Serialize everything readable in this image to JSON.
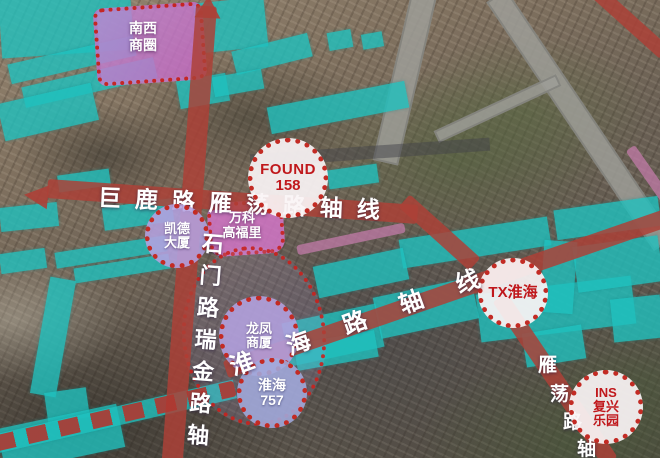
{
  "map": {
    "type": "annotated-satellite-promo-map",
    "zones": {
      "nanxi_shangquan": {
        "line1": "南西",
        "line2": "商圈",
        "full": "南西商圈",
        "fill": "#c186d4"
      },
      "wanke_gaofuli": {
        "line1": "万科",
        "line2": "高福里",
        "full": "万科高福里",
        "fill": "#d276c8"
      }
    },
    "callouts": {
      "found158": {
        "line1": "FOUND",
        "line2": "158",
        "style": "white-dotted-circle"
      },
      "kaide_dasha": {
        "line1": "凯德",
        "line2": "大厦",
        "style": "lavender-dotted-circle"
      },
      "longfeng_shangsha": {
        "line1": "龙凤",
        "line2": "商厦",
        "style": "lavender-dotted-circle"
      },
      "huaihai757": {
        "line1": "淮海",
        "line2": "757",
        "style": "periwinkle-dotted-circle"
      },
      "tx_huaihai": {
        "line1": "TX淮海",
        "style": "white-dotted-circle"
      },
      "ins_fuxing_leyuan": {
        "line1": "INS",
        "line2": "复兴",
        "line3": "乐园",
        "style": "white-dotted-circle"
      }
    },
    "axes": {
      "julu_yandang": {
        "label": "巨鹿路雁荡路轴线",
        "orientation": "horizontal"
      },
      "shimen_ruijin": {
        "label": "石门路瑞金路轴",
        "orientation": "vertical"
      },
      "huaihai": {
        "label": "淮海路轴线",
        "orientation": "diagonal"
      },
      "yandang": {
        "chars": [
          "雁",
          "荡",
          "路",
          "轴"
        ],
        "orientation": "diagonal-down"
      }
    },
    "colors": {
      "cyan_zone": "#1fc0be",
      "red_axis_band": "#ad4037",
      "dot_border_red": "#c32b24",
      "callout_text_red": "#c0181c",
      "purple_zone": "#c186d4",
      "pink_zone": "#d276c8",
      "lavender_circle": "#b4a2e0",
      "highway_gray": "#9e9e98"
    }
  }
}
